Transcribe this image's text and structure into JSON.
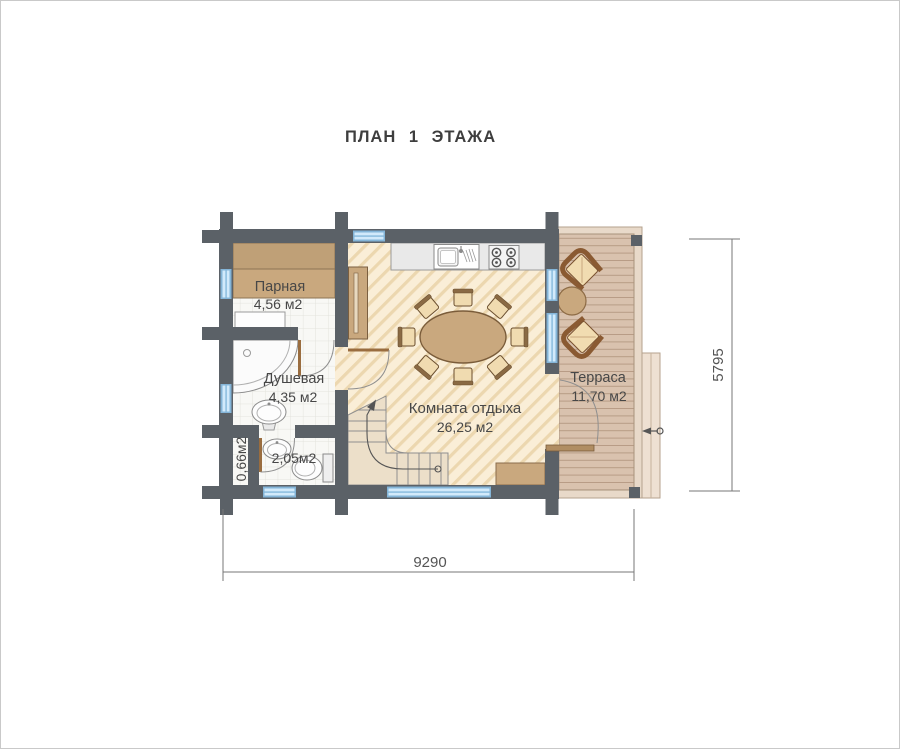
{
  "title": "ПЛАН 1 ЭТАЖА",
  "rooms": {
    "parnaya": {
      "name": "Парная",
      "area": "4,56 м2"
    },
    "dushevaya": {
      "name": "Душевая",
      "area": "4,35 м2"
    },
    "closet": {
      "area": "0,66м2"
    },
    "wc": {
      "area": "2,05м2"
    },
    "lounge": {
      "name": "Комната отдыха",
      "area": "26,25 м2"
    },
    "terrace": {
      "name": "Терраса",
      "area": "11,70 м2"
    }
  },
  "dimensions": {
    "width": "9290",
    "height": "5795"
  },
  "colors": {
    "wall": "#5b6167",
    "wood": "#c9a87e",
    "window": "#d2eafb",
    "floor_hatch": "#ecd7af",
    "deck": "#d9c2ae"
  }
}
